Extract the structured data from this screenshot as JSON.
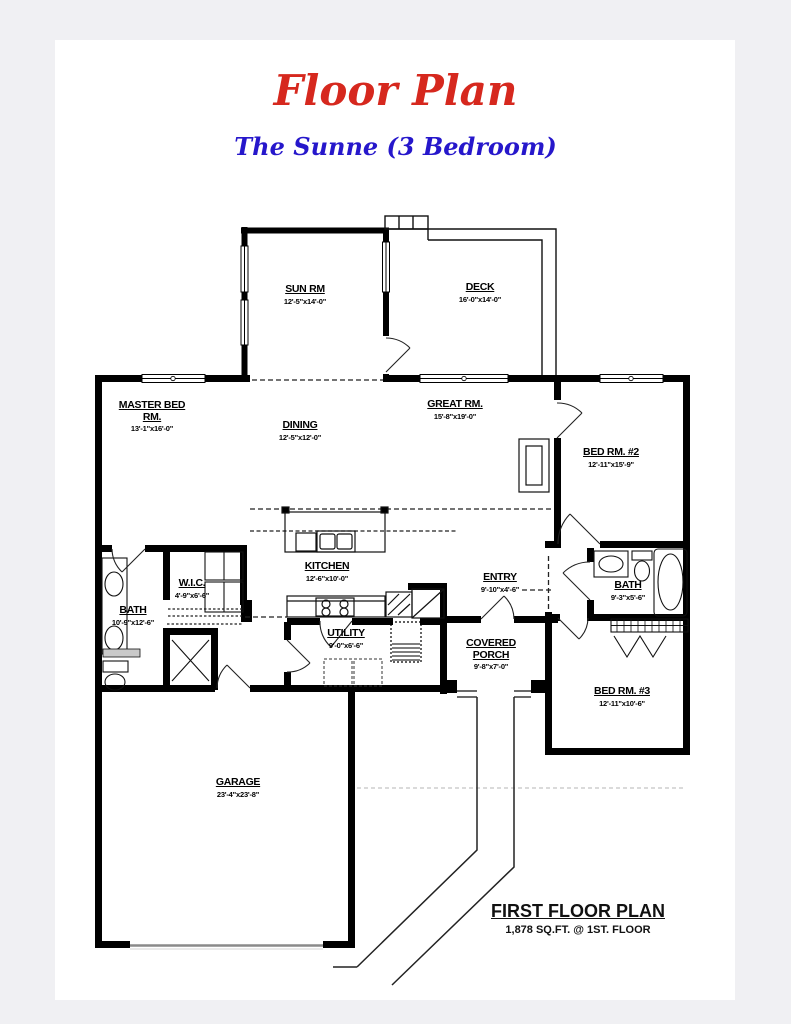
{
  "page": {
    "background": "#f0f0f3",
    "paper_color": "#ffffff",
    "ink_color": "#000000"
  },
  "header": {
    "title": "Floor Plan",
    "title_color": "#d6281e",
    "subtitle": "The Sunne (3 Bedroom)",
    "subtitle_color": "#2617cb"
  },
  "plan": {
    "rooms": [
      {
        "id": "sun-rm",
        "name": "SUN RM",
        "dims": "12'-5\"x14'-0\""
      },
      {
        "id": "deck",
        "name": "DECK",
        "dims": "16'-0\"x14'-0\""
      },
      {
        "id": "master-bed-rm",
        "name": "MASTER BED RM.",
        "dims": "13'-1\"x16'-0\""
      },
      {
        "id": "dining",
        "name": "DINING",
        "dims": "12'-5\"x12'-0\""
      },
      {
        "id": "great-rm",
        "name": "GREAT RM.",
        "dims": "15'-8\"x19'-0\""
      },
      {
        "id": "bed-rm-2",
        "name": "BED RM. #2",
        "dims": "12'-11\"x15'-9\""
      },
      {
        "id": "wic",
        "name": "W.I.C.",
        "dims": "4'-9\"x6'-6\""
      },
      {
        "id": "bath-master",
        "name": "BATH",
        "dims": "10'-9\"x12'-6\""
      },
      {
        "id": "kitchen",
        "name": "KITCHEN",
        "dims": "12'-6\"x10'-0\""
      },
      {
        "id": "entry",
        "name": "ENTRY",
        "dims": "9'-10\"x4'-6\""
      },
      {
        "id": "bath-2",
        "name": "BATH",
        "dims": "9'-3\"x5'-6\""
      },
      {
        "id": "utility",
        "name": "UTILITY",
        "dims": "9'-0\"x6'-6\""
      },
      {
        "id": "covered-porch",
        "name": "COVERED PORCH",
        "dims": "9'-8\"x7'-0\""
      },
      {
        "id": "bed-rm-3",
        "name": "BED RM. #3",
        "dims": "12'-11\"x10'-6\""
      },
      {
        "id": "garage",
        "name": "GARAGE",
        "dims": "23'-4\"x23'-8\""
      }
    ]
  },
  "footer": {
    "title": "FIRST FLOOR PLAN",
    "subtitle": "1,878 SQ.FT. @ 1ST. FLOOR"
  }
}
